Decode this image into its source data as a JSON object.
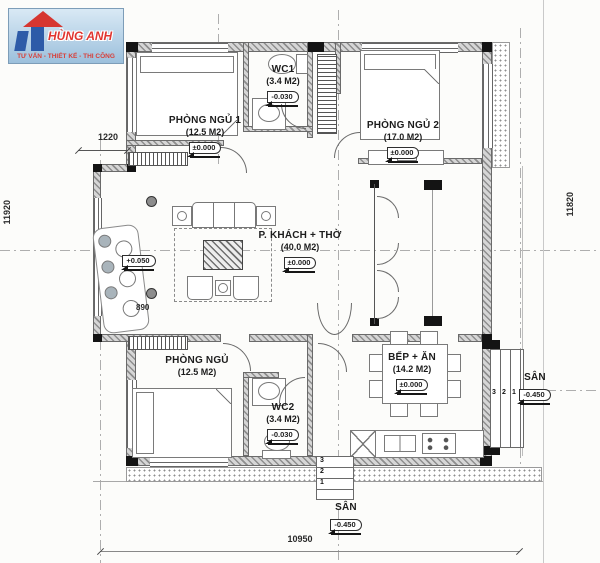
{
  "logo": {
    "brand": "HÙNG ANH",
    "tagline": "TƯ VẤN - THIẾT KẾ - THI CÔNG"
  },
  "rooms": {
    "bedroom1": {
      "name": "PHÒNG NGỦ 1",
      "area": "(12.5 M2)",
      "level": "±0.000"
    },
    "wc1": {
      "name": "WC1",
      "area": "(3.4 M2)",
      "level": "-0.030"
    },
    "bedroom2": {
      "name": "PHÒNG NGỦ 2",
      "area": "(17.0 M2)",
      "level": "±0.000"
    },
    "living": {
      "name": "P. KHÁCH + THỜ",
      "area": "(40.0 M2)",
      "level": "±0.000"
    },
    "bedroom3": {
      "name": "PHÒNG NGỦ",
      "area": "(12.5 M2)"
    },
    "wc2": {
      "name": "WC2",
      "area": "(3.4 M2)",
      "level": "-0.030"
    },
    "kitchen": {
      "name": "BẾP + ĂN",
      "area": "(14.2 M2)",
      "level": "±0.000"
    },
    "yard_right": {
      "name": "SÂN",
      "level": "-0.450"
    },
    "yard_bottom": {
      "name": "SÂN",
      "level": "-0.450"
    }
  },
  "levels": {
    "porch": "+0.050"
  },
  "dimensions": {
    "top_left": "1220",
    "left_total": "11920",
    "right_total": "11820",
    "living_left": "890",
    "bottom_total": "10950"
  },
  "stairs": {
    "right": [
      "3",
      "2",
      "1"
    ],
    "bottom": [
      "3",
      "2",
      "1"
    ]
  },
  "colors": {
    "logo_blue": "#2d5ba8",
    "logo_red": "#d63631",
    "wall_gray": "#8e8e8e"
  }
}
